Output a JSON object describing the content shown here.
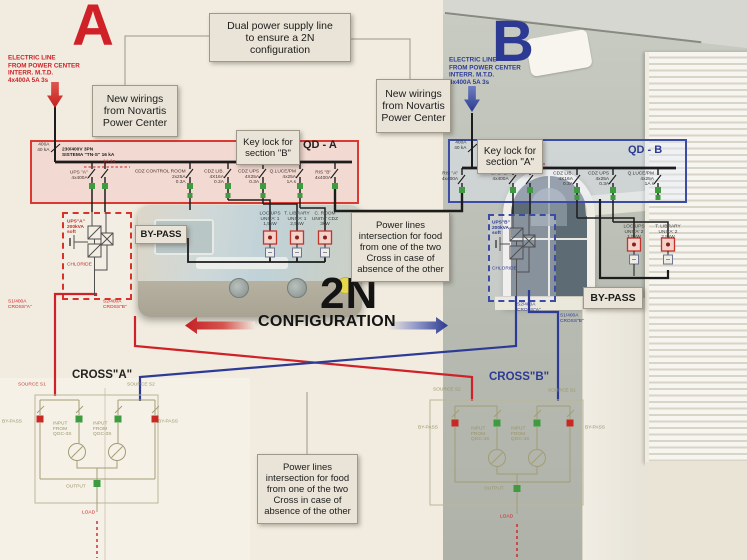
{
  "colors": {
    "red": "#cf2127",
    "blue": "#2b3990",
    "green": "#3f9b3f",
    "olive": "#9a9468"
  },
  "top": {
    "letter_a": "A",
    "letter_b": "B",
    "electric_line_a": "ELECTRIC LINE\nFROM  POWER CENTER\nINTERR. M.T.D.\n4x400A 5A 3s",
    "electric_line_b": "ELECTRIC LINE\nFROM POWER CENTER\nINTERR. M.T.D.\n4x400A 5A 3s",
    "dual_note": "Dual power supply line\nto ensure a 2N\nconfiguration",
    "new_wirings_a": "New wirings\nfrom Novartis\nPower Center",
    "new_wirings_b": "New wirings\nfrom Novartis\nPower Center"
  },
  "qd_a": {
    "title": "QD - A",
    "keylock": "Key lock for\nsection \"B\"",
    "incomer": "400A\n40 kA",
    "bus": "230/400V 3PN\nSISTEMA \"TN-S\" 16 kA",
    "interlock": "1A 1s",
    "breakers": [
      {
        "label": "UPS \"A\"\n4x400A"
      },
      {
        "label": "CDZ CONTROL ROOM\n2x25A\n0.3A"
      },
      {
        "label": "CDZ LIB.\n4X16A\n0.3A"
      },
      {
        "label": "CDZ UPS\n4X25A\n0.3A"
      },
      {
        "label": "Q.LUCE/PM\n4x25A\n1A s"
      },
      {
        "label": "RIS \"B\"\n4x400A"
      }
    ]
  },
  "qd_b": {
    "title": "QD - B",
    "keylock": "Key lock for\nsection \"A\"",
    "incomer": "400A\n40 kA",
    "interlock": "1A 1s",
    "breakers": [
      {
        "label": "RIS \"A\"\n4x400A"
      },
      {
        "label": "UPS \"B\"\n4x400A"
      },
      {
        "label": "CDZ LIB.\n4X16A\n0.3A"
      },
      {
        "label": "CDZ UPS\n4x25A\n0.3A"
      },
      {
        "label": "Q.LUCE/PM\n4x25A\n1A s"
      }
    ]
  },
  "ups_a": {
    "name": "UPS\"A\"\n200kVA\nsoft",
    "brand": "CHLORIDE"
  },
  "ups_b": {
    "name": "UPS\"B\"\n200kVA\nsoft",
    "brand": "CHLORIDE"
  },
  "bypass": {
    "a": "BY-PASS",
    "b": "BY-PASS"
  },
  "loads_a": [
    {
      "label": "LOC.UPS\nUNITA' 1\n1,5kW"
    },
    {
      "label": "T. LIBRARY\nUNITA' 1\n2,5kW"
    },
    {
      "label": "C. ROOM\nUNITA' CDZ\n3kW"
    }
  ],
  "loads_b": [
    {
      "label": "LOC.UPS\nUNITA' 2\n1,5kW"
    },
    {
      "label": "T. LIBRARY\nUNITA' 2\n2,5kW"
    }
  ],
  "feeders": {
    "a_s1": "S1/400A\nCROSS\"A\"",
    "a_s2": "S2/400A\nCROSS\"B\"",
    "b_s2": "S2/400A\nCROSS\"A\"",
    "b_s1": "S1/400A\nCROSS\"B\""
  },
  "center": {
    "big": "2N",
    "caption": "CONFIGURATION"
  },
  "notes": {
    "right": "Power lines\nintersection for food\nfrom one of the two\nCross in case of\nabsence of the other",
    "bottom": "Power lines\nintersection for food\nfrom one of the two\nCross in case of\nabsence of the other"
  },
  "cross_a": {
    "title": "CROSS\"A\"",
    "source_left": "SOURCE S1",
    "source_right": "SOURCE S2",
    "bypass_left": "BY-PASS",
    "bypass_right": "BY-PASS",
    "input_left": "INPUT\nFROM\nQGC-3S",
    "input_right": "INPUT\nFROM\nQGC-3S",
    "output": "OUTPUT",
    "load": "LOAD"
  },
  "cross_b": {
    "title": "CROSS\"B\"",
    "source_left": "SOURCE S2",
    "source_right": "SOURCE S1",
    "bypass_left": "BY-PASS",
    "bypass_right": "BY-PASS",
    "input_left": "INPUT\nFROM\nQGC-3S",
    "input_right": "INPUT\nFROM\nQGC-3S",
    "output": "OUTPUT",
    "load": "LOAD"
  }
}
